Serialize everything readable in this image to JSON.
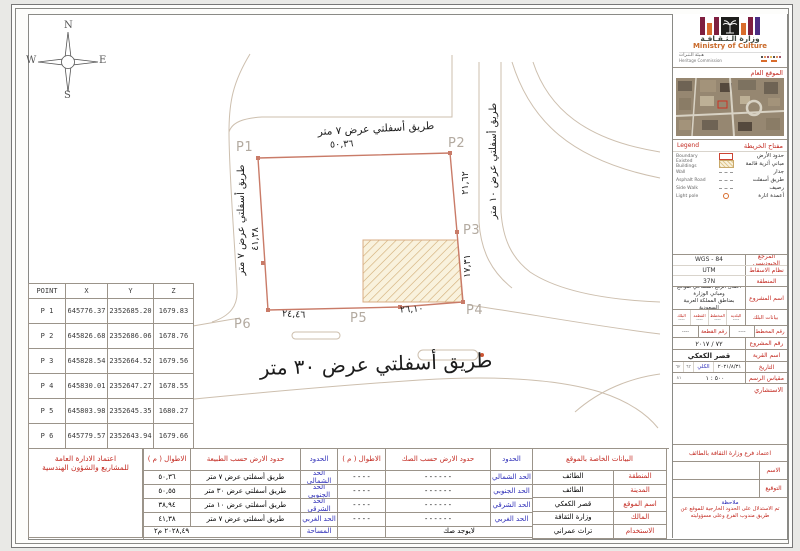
{
  "colors": {
    "label_red": "#c32a21",
    "label_blue": "#2e2eb8",
    "plot_boundary": "#c97b68",
    "road_line": "#cdbfae",
    "hatch": "#c9a96a",
    "logo_maroon": "#7f1f3f",
    "logo_orange": "#d96c2c"
  },
  "compass": {
    "n": "N",
    "e": "E",
    "s": "S",
    "w": "W"
  },
  "coords": {
    "headers": [
      "POINT",
      "X",
      "Y",
      "Z"
    ],
    "rows": [
      [
        "P 1",
        "645776.37",
        "2352685.20",
        "1679.83"
      ],
      [
        "P 2",
        "645826.68",
        "2352686.06",
        "1678.76"
      ],
      [
        "P 3",
        "645828.54",
        "2352664.52",
        "1679.56"
      ],
      [
        "P 4",
        "645830.01",
        "2352647.27",
        "1678.55"
      ],
      [
        "P 5",
        "645803.98",
        "2352645.35",
        "1680.27"
      ],
      [
        "P 6",
        "645779.57",
        "2352643.94",
        "1679.66"
      ]
    ]
  },
  "map": {
    "p1": "P1",
    "p2": "P2",
    "p3": "P3",
    "p4": "P4",
    "p5": "P5",
    "p6": "P6",
    "road_top": "طريق أسفلتي عرض ٧ متر",
    "road_left": "طريق أسفلتي عرض ٧ متر",
    "road_right": "طريق أسفلتي عرض ١٠ متر",
    "road_bottom": "طريق أسفلتي عرض ٣٠ متر",
    "dim_top": "٥٠,٣٦",
    "dim_left": "٤١,٣٨",
    "dim_right_upper": "٢١,٦٢",
    "dim_right_lower": "١٧,٣١",
    "dim_bottom_left": "٢٤,٤٦",
    "dim_bottom_right": "٢٦,١٠"
  },
  "logo": {
    "ministry_ar": "وزارة الـثـقـافـة",
    "ministry_en": "Ministry of Culture",
    "heritage_ar": "هـيئة الـتـراث",
    "heritage_en": "Heritage Commission"
  },
  "sidebar": {
    "site_map_label": "الموقع العام",
    "legend_title_ar": "مفتاح الخريطة",
    "legend_title_en": "Legend",
    "legend_rows": [
      {
        "en": "Boundary",
        "ar": "حدود الأرض",
        "sym": "boundary-red-rect"
      },
      {
        "en": "Existed Buildings",
        "ar": "مباني أثرية قائمة",
        "sym": "tan-hatch"
      },
      {
        "en": "Wall",
        "ar": "جدار",
        "sym": "dashed-line"
      },
      {
        "en": "Asphalt Road",
        "ar": "طريق أسفلت",
        "sym": "dashed-line"
      },
      {
        "en": "Side Walk",
        "ar": "رصيف",
        "sym": "dashed-line"
      },
      {
        "en": "Light pole",
        "ar": "أعمدة انارة",
        "sym": "circle"
      }
    ],
    "geodetic": [
      {
        "label": "المرجع الجيوديسي",
        "value": "WGS - 84"
      },
      {
        "label": "نظام الاسقاط",
        "value": "UTM"
      },
      {
        "label": "المنطقة",
        "value": "37N"
      }
    ],
    "project_name_label": "اسم المشروع",
    "project_name_1": "أعمال الرفع المساحي لمواقع ومباني الوزارة",
    "project_name_2": "بمناطق المملكة العربية السعودية",
    "block_label": "بيانات البلك",
    "block_cells": [
      {
        "h": "البلدية",
        "v": "----"
      },
      {
        "h": "المخطط",
        "v": "----"
      },
      {
        "h": "القطعة",
        "v": "----"
      },
      {
        "h": "البلك",
        "v": "----"
      }
    ],
    "plan_no_label": "رقم المخطط",
    "plan_no_value": "----",
    "parcel_no_label": "رقم القطعة",
    "parcel_no_value": "----",
    "project_no_label": "رقم المشروع",
    "project_no_value": "٧٢ / ٢٠١٧",
    "village_label": "اسم القرية",
    "village_value": "قصر الكعكي",
    "date_label": "التاريخ",
    "date_value": "٢٠٢١/٨/٣١",
    "date_mid": "الكلي",
    "date_c1": "٦٢",
    "date_c2": "٦٣",
    "scale_label": "مقياس الرسم",
    "scale_value": "٥٠٠ : ١",
    "scale_side": "٨١",
    "consultant_label": "الاستشاري",
    "branch_title": "اعتماد فرع وزارة الثقافة بالطائف",
    "branch_name_label": "الاسم",
    "branch_sign_label": "التوقيع",
    "branch_note_label": "ملاحظة",
    "branch_note": "تم الاستدلال على الحدود الخارجية للموقع عن طريق مندوب الفرع وعلى مسؤوليته"
  },
  "bottom": {
    "ga_approval_1": "اعتماد الادارة العامة",
    "ga_approval_2": "للمشاريع والشؤون الهندسية",
    "len_header": "الاطوال ( م )",
    "natural_header": "حدود الارض حسب الطبيعة",
    "deed_header": "حدود الارض حسب الصك",
    "bounds_header": "الحدود",
    "bounds": [
      "الحد الشمالي",
      "الحد الجنوبي",
      "الحد الشرقي",
      "الحد الغربي"
    ],
    "natural_rows": [
      {
        "len": "٥٠,٣٦",
        "desc": "طريق أسفلتي عرض ٧ متر"
      },
      {
        "len": "٥٠,٥٥",
        "desc": "طريق أسفلتي عرض ٣٠ متر"
      },
      {
        "len": "٣٨,٩٤",
        "desc": "طريق أسفلتي عرض ١٠ متر"
      },
      {
        "len": "٤١,٣٨",
        "desc": "طريق أسفلتي عرض ٧ متر"
      }
    ],
    "area_label": "المساحة",
    "area_value": "٢٠٢٨,٤٩ م٢",
    "deed_dash_len": "- - - -",
    "deed_dash_desc": "- - - - - -",
    "no_deed": "لايوجد صك",
    "site_info_header": "البيانات الخاصة بالموقع",
    "site_info": [
      {
        "label": "المنطقة",
        "value": "الطائف"
      },
      {
        "label": "المدينة",
        "value": "الطائف"
      },
      {
        "label": "اسم الموقع",
        "value": "قصر الكعكي"
      },
      {
        "label": "المالك",
        "value": "وزارة الثقافة"
      },
      {
        "label": "الاستخدام",
        "value": "تراث عمراني"
      }
    ]
  }
}
